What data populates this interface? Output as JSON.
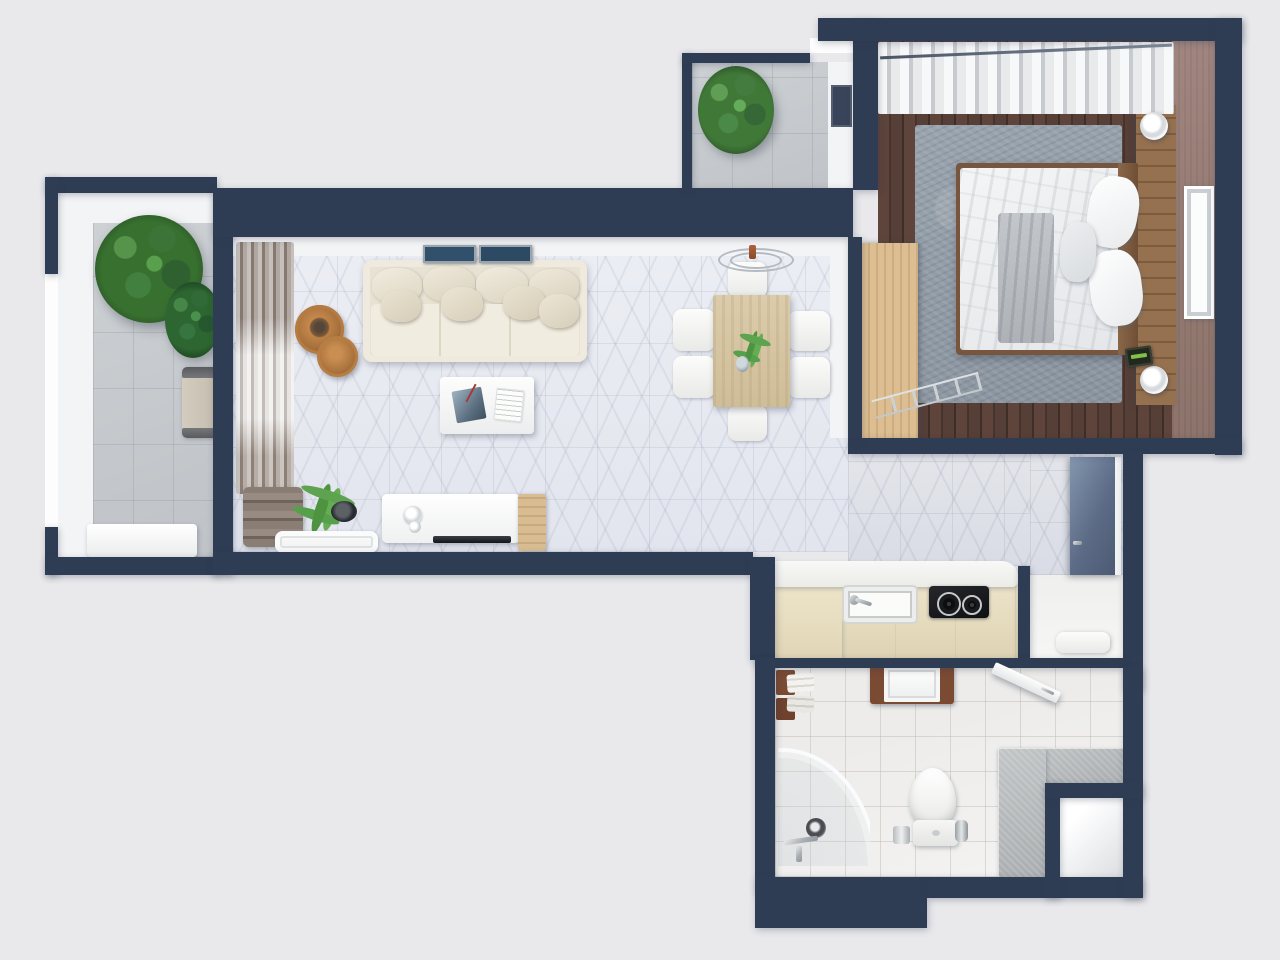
{
  "scene": {
    "type": "3d-floor-plan-top-view-render",
    "description": "Photorealistic top-down 3D render of a one-bedroom apartment floor plan",
    "background_color": "#e9e9ec",
    "wall_color": "#2f3d54"
  },
  "palette": {
    "marble_floor": "#e8ebf2",
    "balcony_tile": "#c8cccf",
    "bedroom_wood_floor": "#523a31",
    "bedroom_rug": "#97a1ab",
    "bedroom_accent_wall": "#9a8078",
    "light_wood": "#d9ba8c",
    "kitchen_beige": "#e6dcc0",
    "stone_bench": "#b6b9bb",
    "sofa_cream": "#e9e4d6",
    "plant_green": "#3c7437"
  },
  "rooms": {
    "living_room": "Living room",
    "dining_area": "Dining area",
    "bedroom": "Bedroom",
    "kitchen": "Kitchen",
    "bathroom": "Bathroom",
    "hallway": "Entry hall",
    "balcony_left": "Side balcony",
    "balcony_top": "Upper balcony",
    "utility_niche": "Utility niche"
  },
  "labels": {
    "floor_plan": "Apartment floor plan (3D top view)",
    "living_floor": "Living room marble floor",
    "corridor_floor": "Corridor marble floor",
    "hall_floor": "Entry hall floor",
    "balcony_left_floor": "Side balcony tiled floor",
    "balcony_top_floor": "Upper balcony tiled floor",
    "bedroom_floor": "Bedroom hardwood floor",
    "bathroom_floor": "Bathroom tiled floor",
    "niche_floor": "Utility niche",
    "sofa": "Cream fabric sofa",
    "sofa_pillow": "Sofa cushion",
    "coffee_table": "White coffee table with magazines",
    "magazine": "Magazine",
    "book": "Book",
    "nesting_table_large": "Round wooden nesting table (large)",
    "nesting_table_small": "Round wooden nesting table (small)",
    "tv_console": "White media console",
    "tv_screen": "Flat TV",
    "console_knobs": "Speaker knobs",
    "wood_cabinet": "Small wooden cabinet",
    "white_tray": "White floor tray",
    "towel_stack": "Folded fabric stack",
    "living_plant": "Potted grass plant",
    "drapes": "Gray drapes with sheer curtain",
    "picture_frame": "Picture frame",
    "dining_table": "Wooden dining table",
    "dining_chair": "White dining chair",
    "pendant_lamp": "Wire pendant lamp",
    "dining_plant": "Fern centerpiece",
    "dining_cup": "Glass cup",
    "bed": "Double bed",
    "duvet": "White duvet",
    "blanket": "Gray throw blanket",
    "bed_pillow": "Bed pillow",
    "headboard": "Wooden headboard",
    "headboard_shelf": "Headboard shelf",
    "bedside_lamp": "Bedside lamp",
    "alarm_clock": "Alarm clock",
    "bedroom_rug": "Gray shag rug",
    "wardrobe": "Light wood wardrobe",
    "ladder_rack": "Ladder clothes rack",
    "bedroom_window": "Bedroom window",
    "bedroom_curtains": "Sheer window curtains",
    "curtain_rod": "Curtain rod",
    "balcony_plant_large": "Large potted plant",
    "balcony_plant_small": "Small potted shrub",
    "balcony_chair": "Balcony armchair",
    "balcony_bench": "White balcony bench",
    "balcony_top_plant": "Potted plant",
    "balcony_window": "Balcony window",
    "kitchen_counter": "Kitchen countertop",
    "kitchen_cabinets": "Kitchen base cabinets",
    "kitchen_return": "Kitchen corner cabinet",
    "kitchen_sink": "Kitchen sink",
    "kitchen_faucet": "Kitchen faucet",
    "cooktop": "Two-burner cooktop",
    "cooktop_burner": "Burner",
    "washing_machine": "Washing machine in wooden cabinet",
    "bath_shelf": "Wooden bathroom shelf",
    "bath_towels": "Folded towels",
    "bathroom_door": "Bathroom door (open)",
    "shower": "Curved glass shower enclosure",
    "shower_head": "Shower head",
    "shower_faucet": "Shower fixtures",
    "toilet": "Wall-hung toilet",
    "toilet_paper": "Toilet paper holder",
    "toilet_brush": "Toilet brush",
    "stone_bench": "Stone bench",
    "entry_door": "Entry door",
    "hall_bench": "White hall bench",
    "wall": "Wall"
  }
}
